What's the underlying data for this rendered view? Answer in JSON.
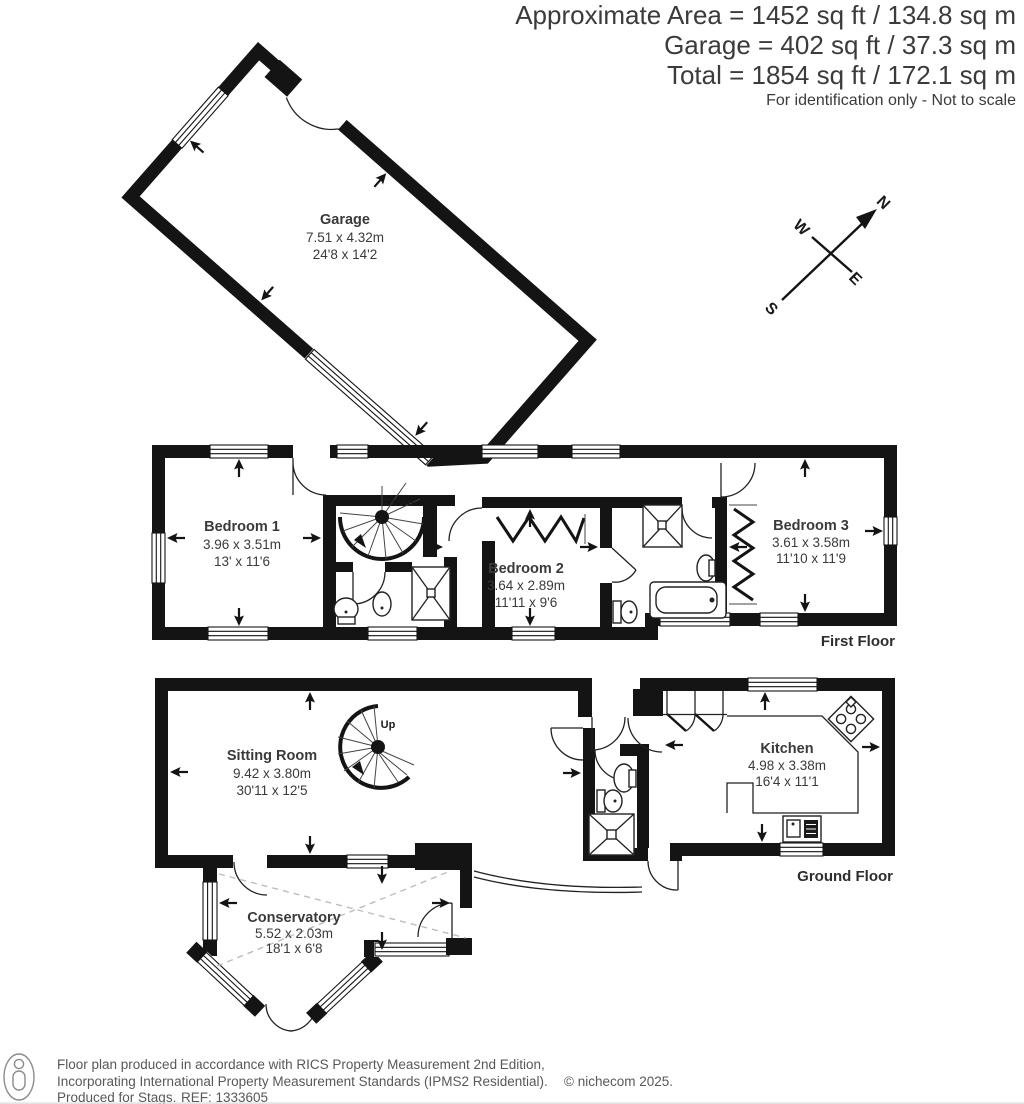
{
  "header": {
    "line1": "Approximate Area = 1452 sq ft / 134.8 sq m",
    "line2": "Garage = 402 sq ft / 37.3 sq m",
    "line3": "Total = 1854 sq ft / 172.1 sq m",
    "disclaimer": "For identification only - Not to scale"
  },
  "compass": {
    "n": "N",
    "e": "E",
    "s": "S",
    "w": "W"
  },
  "garage": {
    "name": "Garage",
    "metric": "7.51 x 4.32m",
    "imperial": "24'8 x 14'2"
  },
  "first_floor": {
    "label": "First Floor",
    "stairs": "Down",
    "bedroom1": {
      "name": "Bedroom 1",
      "metric": "3.96 x 3.51m",
      "imperial": "13' x 11'6"
    },
    "bedroom2": {
      "name": "Bedroom 2",
      "metric": "3.64 x 2.89m",
      "imperial": "11'11 x 9'6"
    },
    "bedroom3": {
      "name": "Bedroom 3",
      "metric": "3.61 x 3.58m",
      "imperial": "11'10 x 11'9"
    }
  },
  "ground_floor": {
    "label": "Ground Floor",
    "stairs": "Up",
    "sitting_room": {
      "name": "Sitting Room",
      "metric": "9.42 x 3.80m",
      "imperial": "30'11 x 12'5"
    },
    "kitchen": {
      "name": "Kitchen",
      "metric": "4.98 x 3.38m",
      "imperial": "16'4 x 11'1"
    },
    "conservatory": {
      "name": "Conservatory",
      "metric": "5.52 x 2.03m",
      "imperial": "18'1 x 6'8"
    }
  },
  "footer": {
    "line1": "Floor plan produced in accordance with RICS Property Measurement 2nd Edition,",
    "line2": "Incorporating International Property Measurement Standards (IPMS2 Residential).",
    "produced_for": "Produced for Stags.",
    "ref": "REF: 1333605",
    "copyright": "© nichecom 2025."
  },
  "colors": {
    "wall": "#141414",
    "text": "#3a3a3a",
    "muted": "#585858",
    "dash": "#bdbdbd"
  }
}
